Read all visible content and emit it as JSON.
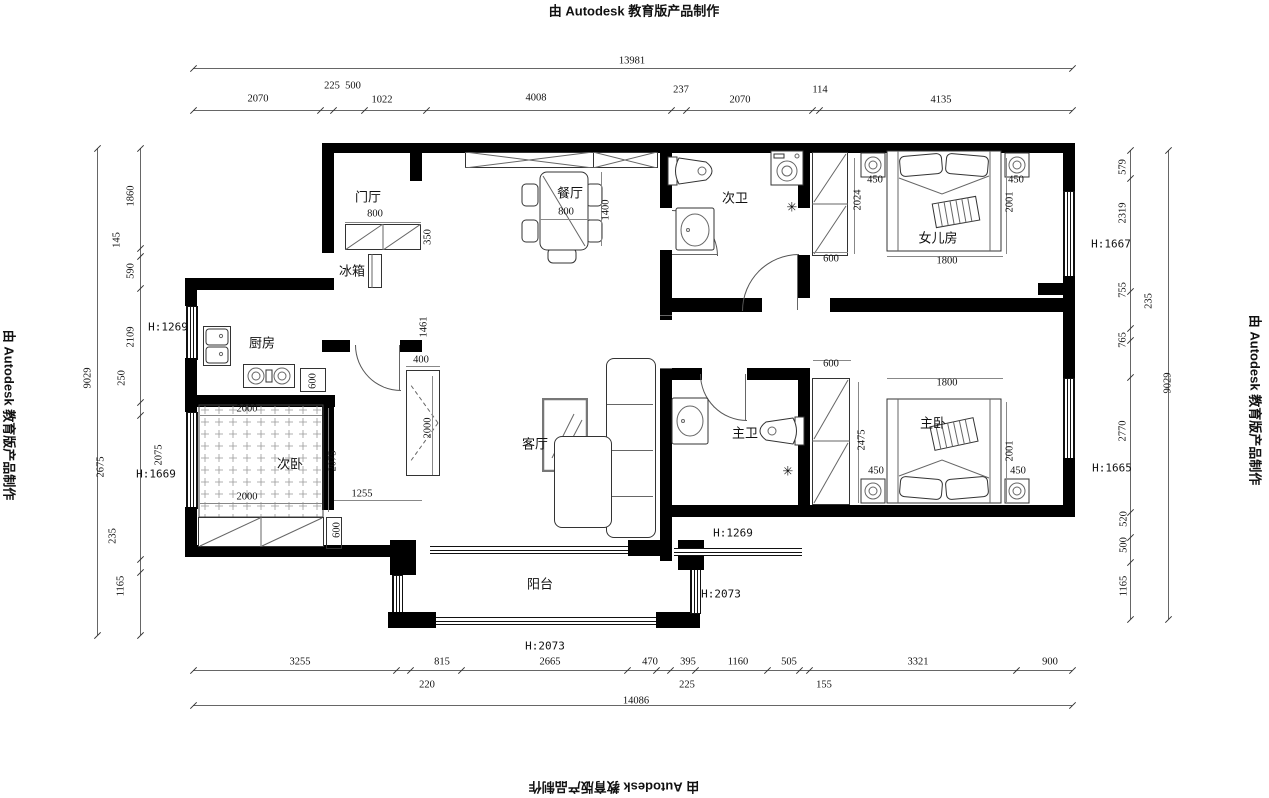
{
  "watermark": {
    "text": "由 Autodesk 教育版产品制作"
  },
  "rooms": {
    "foyer": "门厅",
    "fridge": "冰箱",
    "dining": "餐厅",
    "kitchen": "厨房",
    "bedroom2": "次卧",
    "living": "客厅",
    "bath2": "次卫",
    "daughter_room": "女儿房",
    "master_bath": "主卫",
    "master_bedroom": "主卧",
    "balcony": "阳台"
  },
  "dims": {
    "top_overall": "13981",
    "top": [
      "2070",
      "225",
      "500",
      "1022",
      "4008",
      "237",
      "2070",
      "114",
      "4135"
    ],
    "bottom": [
      "3255",
      "220",
      "815",
      "2665",
      "470",
      "225",
      "395",
      "1160",
      "505",
      "155",
      "3321",
      "900"
    ],
    "bottom_overall": "14086",
    "left": [
      "1860",
      "145",
      "590",
      "2109",
      "250",
      "2675",
      "235",
      "1165"
    ],
    "left_inner": "2075",
    "left_overall": "9029",
    "right": [
      "579",
      "2319",
      "755",
      "235",
      "765",
      "2770",
      "520",
      "500",
      "1165"
    ],
    "right_overall": "9029"
  },
  "heights": {
    "kitchen_window": "H:1269",
    "bedroom2_window": "H:1669",
    "daughter_window": "H:1667",
    "master_window": "H:1665",
    "hallway": "H:1269",
    "balcony_right": "H:2073",
    "balcony_bottom": "H:2073"
  },
  "interior": {
    "foyer_cabinet_w": "800",
    "foyer_cabinet_d": "350",
    "dining_table_w": "800",
    "dining_table_l": "1400",
    "kitchen_door": "1461",
    "kitchen_cabinet": "600",
    "bed2_top": "2000",
    "bed2_bottom": "2000",
    "bed2_side": "2075",
    "bed2_gap": "1255",
    "bed2_cabinet": "600",
    "tv_cabinet_w": "400",
    "tv_cabinet_l": "2000",
    "wardrobe2_w": "600",
    "wardrobe2_l": "2024",
    "daughter_nightstand_l": "450",
    "daughter_nightstand_r": "450",
    "daughter_bed_w": "1800",
    "daughter_bed_l": "2001",
    "master_wardrobe_w": "600",
    "master_wardrobe_l": "2475",
    "master_nightstand_l": "450",
    "master_nightstand_r": "450",
    "master_bed_w": "1800",
    "master_bed_l": "2001"
  },
  "icons": {
    "shower": "✳"
  }
}
